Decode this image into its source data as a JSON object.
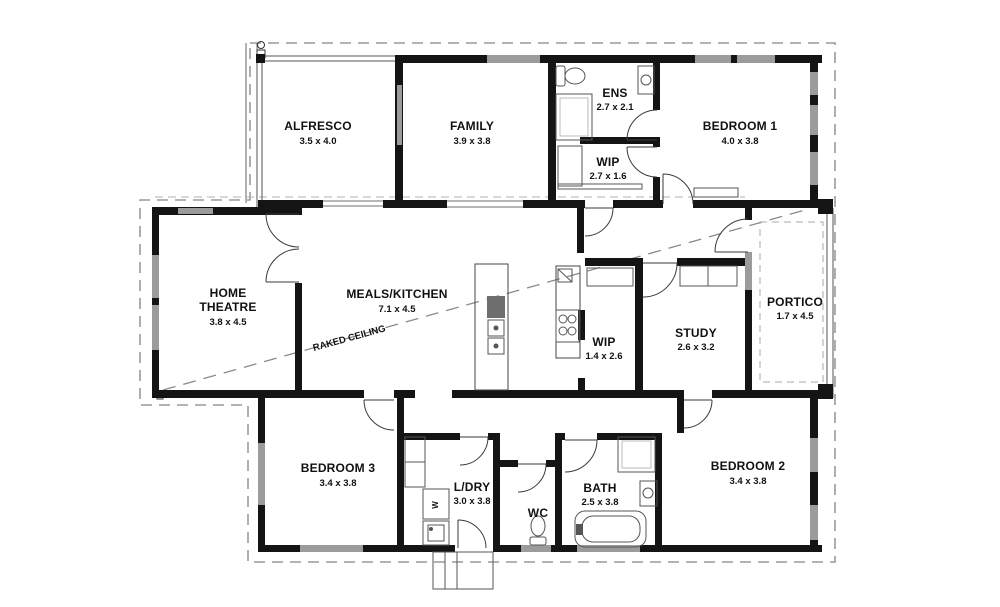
{
  "plan": {
    "rooms": {
      "alfresco": {
        "name": "ALFRESCO",
        "dims": "3.5 x 4.0"
      },
      "family": {
        "name": "FAMILY",
        "dims": "3.9 x 3.8"
      },
      "ens": {
        "name": "ENS",
        "dims": "2.7 x 2.1"
      },
      "wip_robe": {
        "name": "WIP",
        "dims": "2.7 x 1.6"
      },
      "bedroom1": {
        "name": "BEDROOM 1",
        "dims": "4.0 x 3.8"
      },
      "home_theatre": {
        "line1": "HOME",
        "line2": "THEATRE",
        "dims": "3.8 x 4.5"
      },
      "meals_kitchen": {
        "name": "MEALS/KITCHEN",
        "dims": "7.1 x 4.5"
      },
      "wip_pantry": {
        "name": "WIP",
        "dims": "1.4 x 2.6"
      },
      "study": {
        "name": "STUDY",
        "dims": "2.6 x 3.2"
      },
      "portico": {
        "name": "PORTICO",
        "dims": "1.7 x 4.5"
      },
      "bedroom3": {
        "name": "BEDROOM 3",
        "dims": "3.4 x 3.8"
      },
      "ldry": {
        "name": "L/DRY",
        "dims": "3.0 x 3.8"
      },
      "wc": {
        "name": "WC"
      },
      "bath": {
        "name": "BATH",
        "dims": "2.5 x 3.8"
      },
      "bedroom2": {
        "name": "BEDROOM 2",
        "dims": "3.4 x 3.8"
      }
    },
    "annotations": {
      "raked_ceiling": "RAKED CEILING",
      "washer_glyph": "W"
    },
    "colors": {
      "wall": "#141414",
      "window": "#9b9b9b",
      "boundary": "#9a9a9a",
      "thin_line": "#555555"
    }
  }
}
